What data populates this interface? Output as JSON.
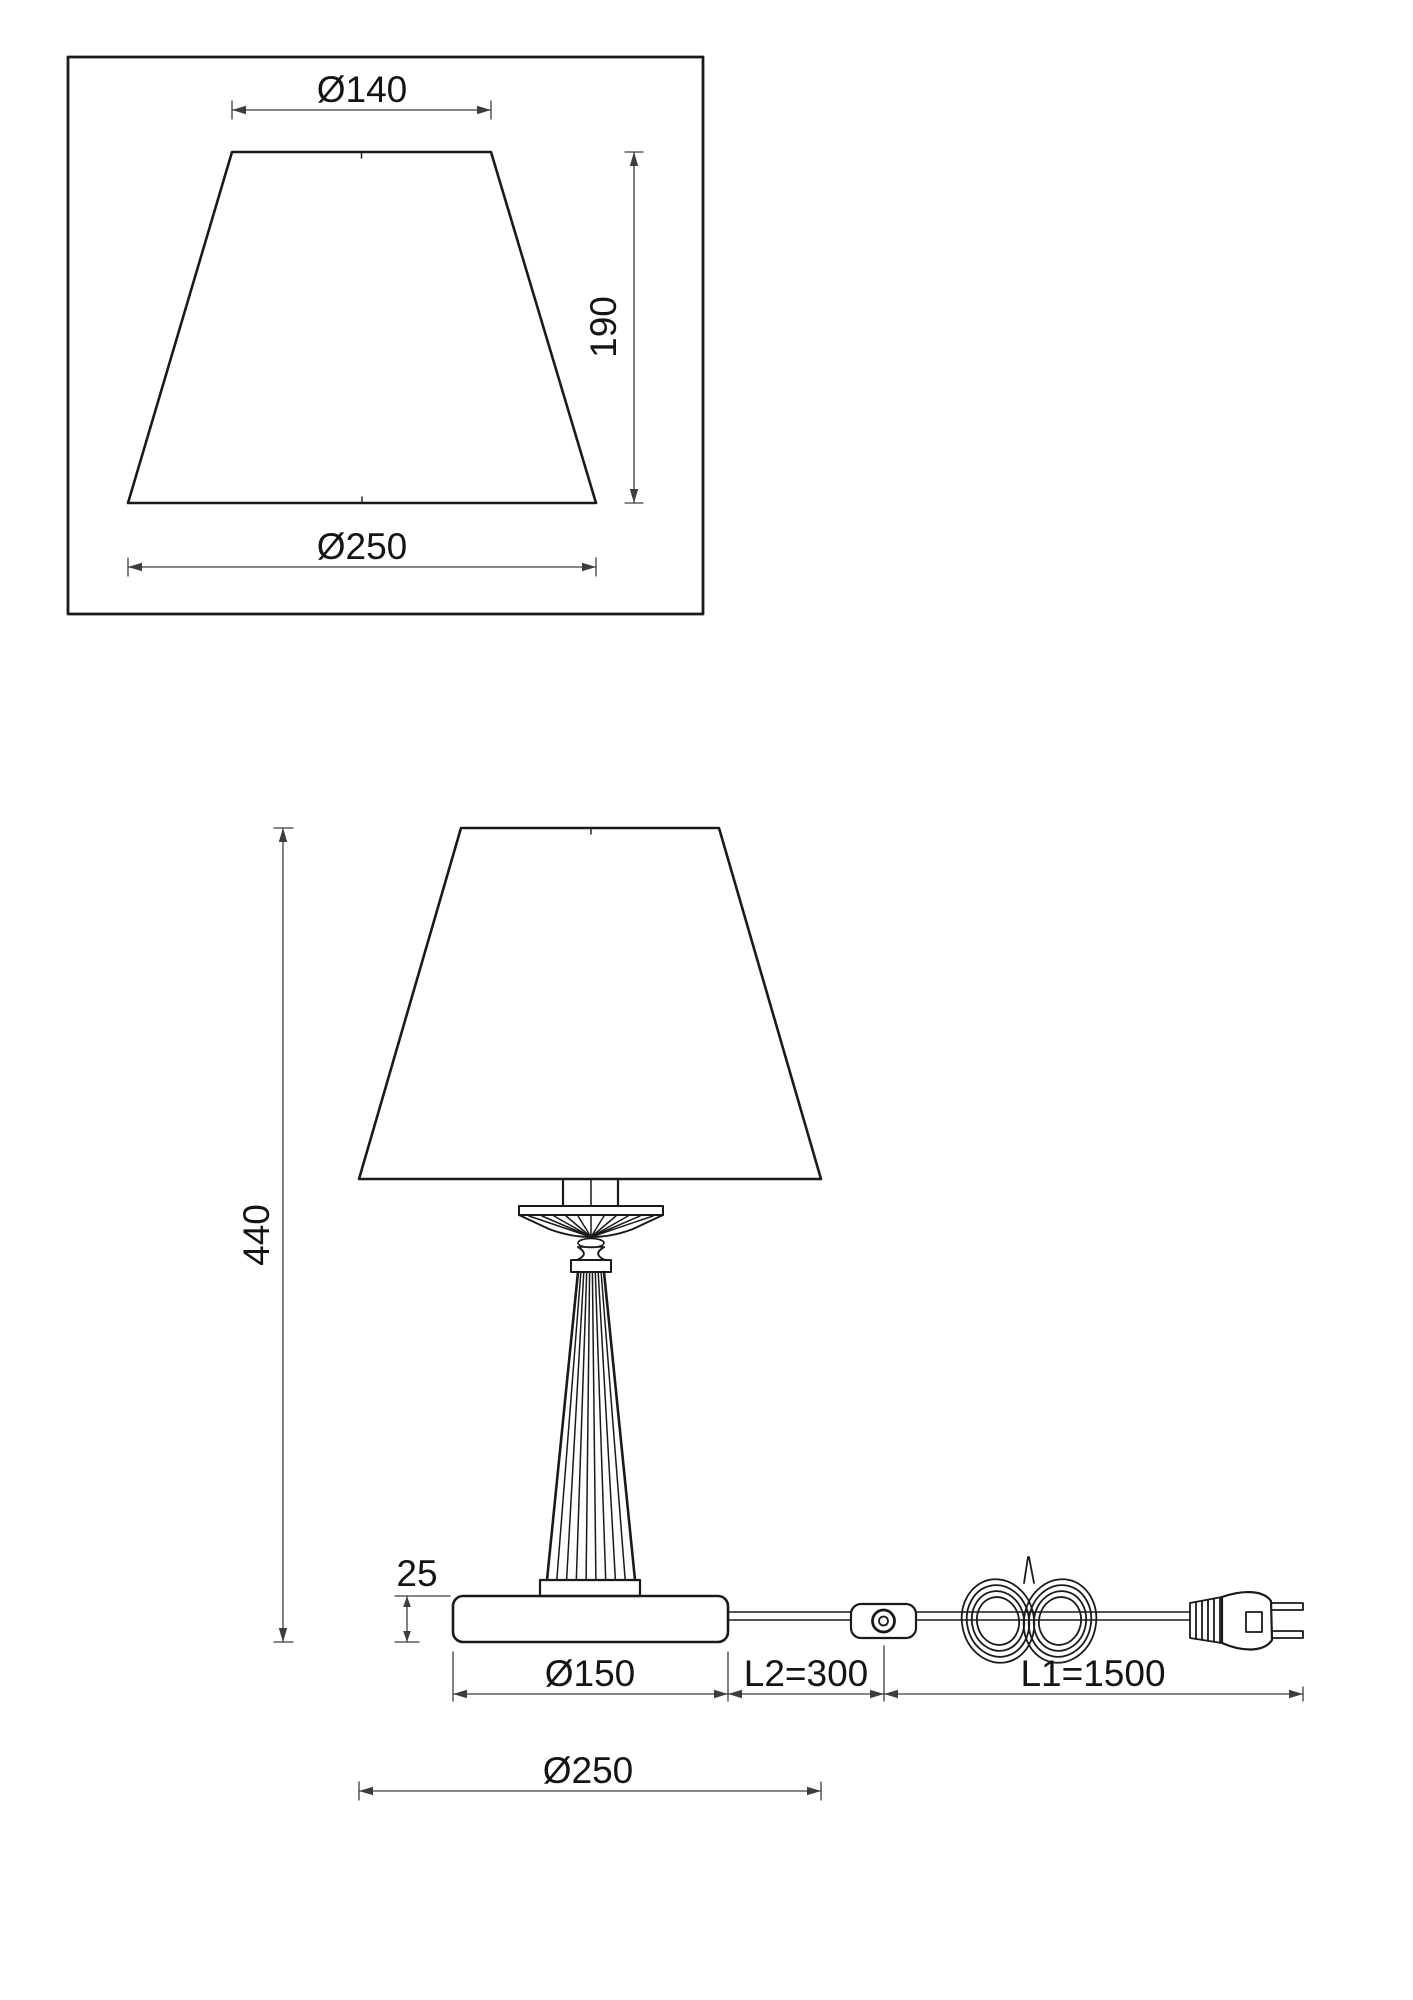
{
  "drawing": {
    "colors": {
      "object_line": "#1a1a1a",
      "dimension_line": "#3d3d3d",
      "text": "#141414",
      "background": "#ffffff"
    },
    "shade_detail": {
      "top_diameter_label": "Ø140",
      "height_label": "190",
      "bottom_diameter_label": "Ø250"
    },
    "elevation": {
      "total_height_label": "440",
      "base_height_label": "25",
      "base_diameter_label": "Ø150",
      "switch_distance_label": "L2=300",
      "cord_length_label": "L1=1500",
      "shade_diameter_label": "Ø250"
    }
  }
}
